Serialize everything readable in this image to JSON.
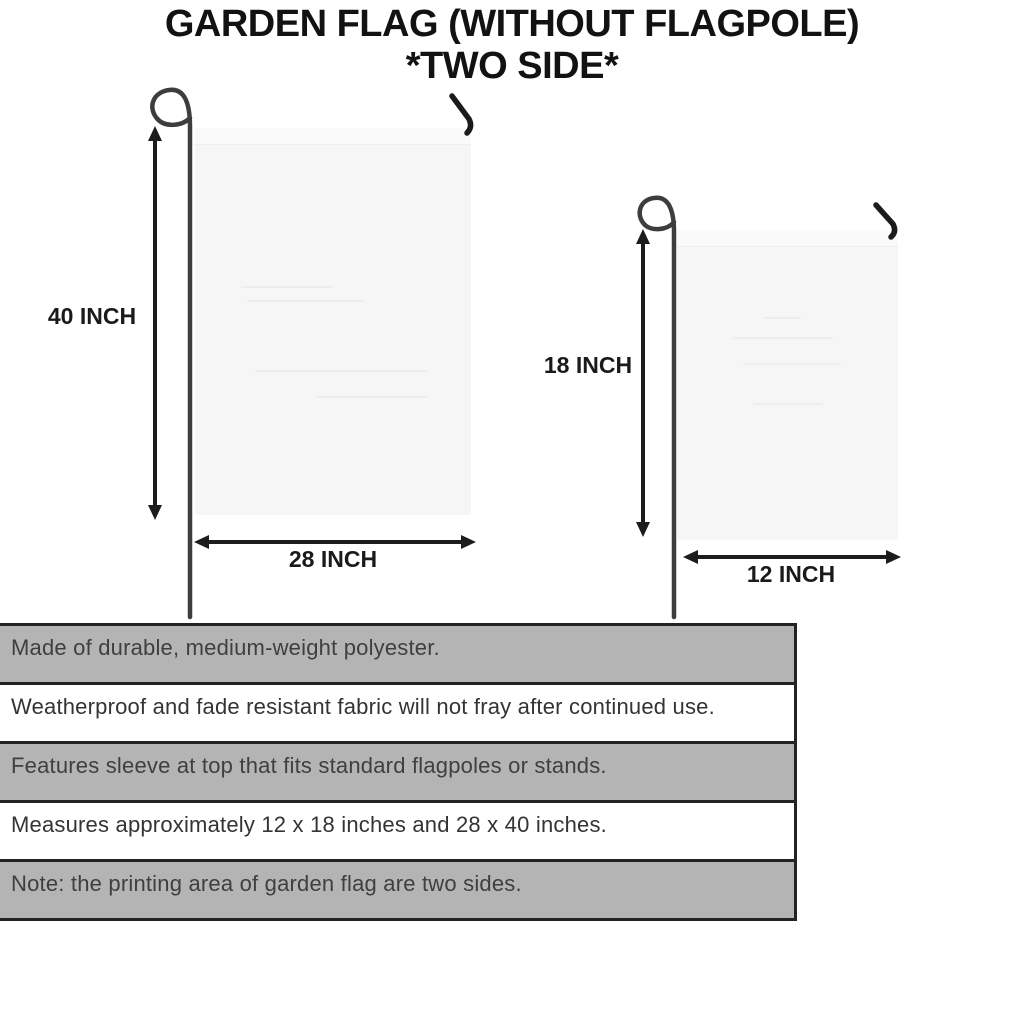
{
  "title": {
    "line1": "GARDEN FLAG (WITHOUT FLAGPOLE)",
    "line2": "*TWO SIDE*"
  },
  "flags": {
    "large": {
      "height_label": "40 INCH",
      "width_label": "28 INCH"
    },
    "small": {
      "height_label": "18 INCH",
      "width_label": "12 INCH"
    }
  },
  "features": [
    "Made of durable, medium-weight polyester.",
    "Weatherproof and fade resistant fabric will not fray after continued use.",
    "Features sleeve at top that fits standard flagpoles or stands.",
    "Measures approximately 12 x 18 inches and 28 x 40 inches.",
    "Note: the printing area of garden flag are two sides."
  ],
  "icons": {
    "pole_icon": "flagpole-with-loop",
    "hook_icon": "hanger-hook",
    "arrow_icon": "double-headed-measure-arrow"
  },
  "colors": {
    "background": "#ffffff",
    "title_text": "#121212",
    "flag_fabric": "#f6f6f6",
    "pole": "#3d3d3d",
    "hook": "#1b1b1b",
    "arrow": "#1c1c1c",
    "stripe_gray": "#b4b4b4",
    "stripe_white": "#ffffff",
    "stripe_border": "#232323",
    "stripe_text": "#3f3f3f"
  }
}
